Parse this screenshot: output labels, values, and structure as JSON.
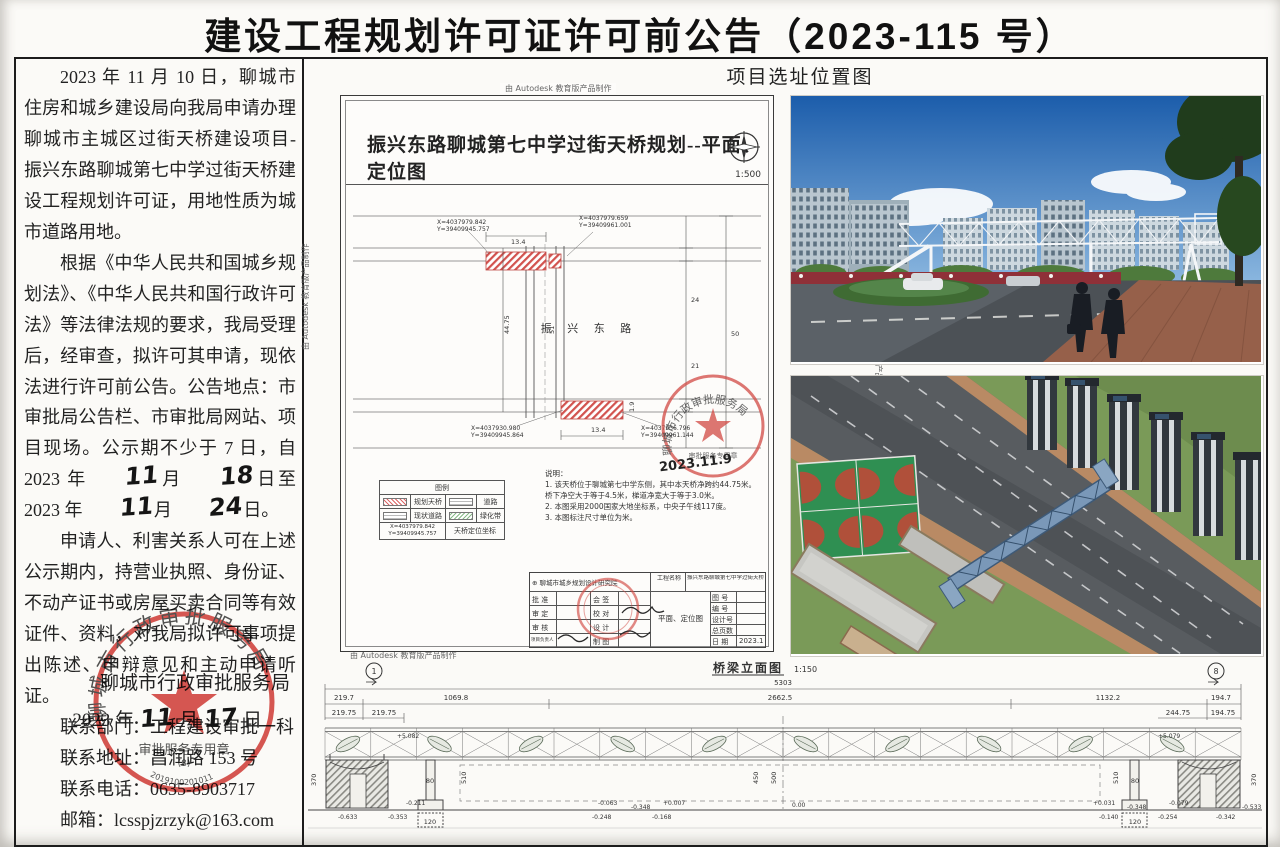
{
  "title": "建设工程规划许可证许可前公告（2023-115 号）",
  "notice": {
    "p1": "2023 年 11 月 10 日，聊城市住房和城乡建设局向我局申请办理聊城市主城区过街天桥建设项目-振兴东路聊城第七中学过街天桥建设工程规划许可证，用地性质为城市道路用地。",
    "p2_pre": "根据《中华人民共和国城乡规划法》、《中华人民共和国行政许可法》等法律法规的要求，我局受理后，经审查，拟许可其申请，现依法进行许可前公告。公告地点：市审批局公告栏、市审批局网站、项目现场。公示期不少于 7 日，自 2023 年",
    "hw_month_start": "11",
    "month_char1": "月",
    "hw_day_start": "18",
    "p2_mid": "日至 2023 年",
    "hw_month_end": "11",
    "month_char2": "月",
    "hw_day_end": "24",
    "p2_end": "日。",
    "p3": "申请人、利害关系人可在上述公示期内，持营业执照、身份证、不动产证书或房屋买卖合同等有效证件、资料，对我局拟许可事项提出陈述、申辩意见和主动申请听证。",
    "contact_dept": "联系部门：工程建设审批一科",
    "contact_addr": "联系地址：昌润路 153 号",
    "contact_tel": "联系电话：0635-8903717",
    "contact_mail": "邮箱：lcsspjzrzyk@163.com",
    "signer": "聊城市行政审批服务局",
    "sign_year": "2023 年",
    "sign_hw_month": "11",
    "sign_month_char": "月",
    "sign_hw_day": "17",
    "sign_day_char": "日"
  },
  "seal": {
    "ring": "聊城市行政审批服务局",
    "inner": "审批服务专用章",
    "code": "(8)",
    "serial": "2019100201011"
  },
  "plan": {
    "autodesk": "由 Autodesk 教育版产品制作",
    "title": "振兴东路聊城第七中学过街天桥规划--平面、定位图",
    "scale": "1:500",
    "road": "振 兴 东 路",
    "stamp_date": "2023.11.9",
    "coords": [
      {
        "x": 96,
        "y": 128,
        "l1": "X=4037979.842",
        "l2": "Y=39409945.757"
      },
      {
        "x": 238,
        "y": 124,
        "l1": "X=4037979.659",
        "l2": "Y=39409961.001"
      },
      {
        "x": 130,
        "y": 334,
        "l1": "X=4037930.980",
        "l2": "Y=39409945.864"
      },
      {
        "x": 300,
        "y": 334,
        "l1": "X=4037936.796",
        "l2": "Y=39409961.144"
      }
    ],
    "labels": [
      {
        "t": "13.4",
        "x": 170,
        "y": 148
      },
      {
        "t": "13.4",
        "x": 250,
        "y": 336
      },
      {
        "t": "1.9",
        "x": 293,
        "y": 316,
        "c": "rot"
      },
      {
        "t": "44.75",
        "x": 168,
        "y": 238,
        "c": "rot"
      },
      {
        "t": "51",
        "x": 213,
        "y": 238,
        "c": "rot"
      },
      {
        "t": "24",
        "x": 350,
        "y": 206
      },
      {
        "t": "21",
        "x": 350,
        "y": 272
      },
      {
        "t": "50",
        "x": 390,
        "y": 240
      }
    ],
    "notes_title": "说明：",
    "notes": [
      "1. 该天桥位于聊城第七中学东侧，其中本天桥净跨约44.75米。",
      "    桥下净空大于等于4.5米，梯道净宽大于等于3.0米。",
      "2. 本图采用2000国家大地坐标系，中央子午线117度。",
      "3. 本图标注尺寸单位为米。"
    ],
    "legend": {
      "title": "图例",
      "r1a": "规划天桥",
      "r1b": "道路",
      "r2a": "现状道路",
      "r2b": "绿化带",
      "coord1": "X=4037979.842",
      "coord2": "Y=39409945.757",
      "coord_desc": "天桥定位坐标"
    },
    "tb": {
      "institute": "聊城市城乡规划设计研究院",
      "project_label": "工程名称",
      "project": "振兴东路聊城第七中学过街天桥",
      "c1": [
        "批 准",
        "审 定",
        "审 核",
        "项目负责人"
      ],
      "c2": [
        "会 签",
        "校 对",
        "设 计",
        "制 图"
      ],
      "drawing": "平面、定位图",
      "r": [
        "图 号",
        "编 号",
        "设计号",
        "总页数",
        "日 期"
      ],
      "date": "2023.10"
    }
  },
  "photos": {
    "header": "项目选址位置图"
  },
  "elevation": {
    "title": "桥梁立面图",
    "scale": "1:150",
    "axis_left": "1",
    "axis_right": "8",
    "marks": [
      {
        "t": "5303",
        "x": 483,
        "y": 27,
        "c": "dim"
      },
      {
        "t": "219.7",
        "x": 44,
        "y": 42,
        "c": "dim"
      },
      {
        "t": "1069.8",
        "x": 156,
        "y": 42,
        "c": "dim"
      },
      {
        "t": "2662.5",
        "x": 480,
        "y": 42,
        "c": "dim"
      },
      {
        "t": "1132.2",
        "x": 808,
        "y": 42,
        "c": "dim"
      },
      {
        "t": "194.7",
        "x": 921,
        "y": 42,
        "c": "dim"
      },
      {
        "t": "219.75",
        "x": 44,
        "y": 57,
        "c": "dim"
      },
      {
        "t": "219.75",
        "x": 84,
        "y": 57,
        "c": "dim"
      },
      {
        "t": "244.75",
        "x": 878,
        "y": 57,
        "c": "dim"
      },
      {
        "t": "194.75",
        "x": 923,
        "y": 57,
        "c": "dim"
      },
      {
        "t": "+5.082",
        "x": 97,
        "y": 80,
        "c": "lvl"
      },
      {
        "t": "+5.079",
        "x": 858,
        "y": 80,
        "c": "lvl"
      },
      {
        "t": "80",
        "x": 130,
        "y": 125,
        "c": "box"
      },
      {
        "t": "80",
        "x": 835,
        "y": 125,
        "c": "box"
      },
      {
        "t": "120",
        "x": 130,
        "y": 166,
        "c": "box"
      },
      {
        "t": "120",
        "x": 835,
        "y": 166,
        "c": "box"
      },
      {
        "t": "510",
        "x": 166,
        "y": 126,
        "c": "rot"
      },
      {
        "t": "450",
        "x": 458,
        "y": 126,
        "c": "rot"
      },
      {
        "t": "500",
        "x": 476,
        "y": 126,
        "c": "rot"
      },
      {
        "t": "510",
        "x": 818,
        "y": 126,
        "c": "rot"
      },
      {
        "t": "370",
        "x": 16,
        "y": 128,
        "c": "rot"
      },
      {
        "t": "370",
        "x": 956,
        "y": 128,
        "c": "rot"
      },
      {
        "t": "0.00",
        "x": 492,
        "y": 149,
        "c": "lvl"
      },
      {
        "t": "-0.633",
        "x": 38,
        "y": 161,
        "c": "lvl"
      },
      {
        "t": "-0.211",
        "x": 106,
        "y": 147,
        "c": "lvl"
      },
      {
        "t": "-0.353",
        "x": 88,
        "y": 161,
        "c": "lvl"
      },
      {
        "t": "-0.063",
        "x": 298,
        "y": 147,
        "c": "lvl"
      },
      {
        "t": "-0.248",
        "x": 292,
        "y": 161,
        "c": "lvl"
      },
      {
        "t": "-0.348",
        "x": 331,
        "y": 151,
        "c": "lvl"
      },
      {
        "t": "+0.007",
        "x": 363,
        "y": 147,
        "c": "lvl"
      },
      {
        "t": "-0.168",
        "x": 352,
        "y": 161,
        "c": "lvl"
      },
      {
        "t": "+0.031",
        "x": 793,
        "y": 147,
        "c": "lvl"
      },
      {
        "t": "-0.140",
        "x": 799,
        "y": 161,
        "c": "lvl"
      },
      {
        "t": "-0.348",
        "x": 827,
        "y": 151,
        "c": "lvl"
      },
      {
        "t": "-0.079",
        "x": 869,
        "y": 147,
        "c": "lvl"
      },
      {
        "t": "-0.254",
        "x": 858,
        "y": 161,
        "c": "lvl"
      },
      {
        "t": "-0.342",
        "x": 916,
        "y": 161,
        "c": "lvl"
      },
      {
        "t": "-0.533",
        "x": 942,
        "y": 151,
        "c": "lvl"
      }
    ]
  }
}
